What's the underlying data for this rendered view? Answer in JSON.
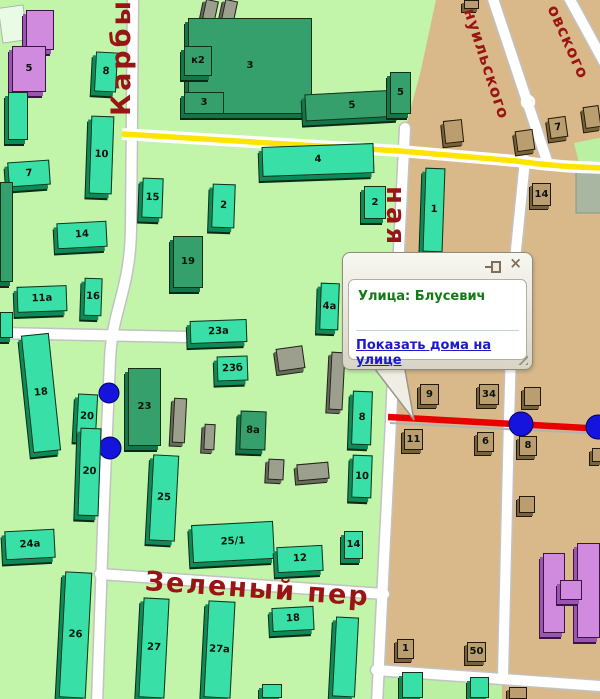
{
  "colors": {
    "map_green": "#c2f4aa",
    "map_tan": "#d9b989",
    "road_yellow": "#ffe400",
    "accent_red": "#e80000",
    "marker_blue": "#1414dd",
    "street_label": "#991414",
    "popup_title_green": "#157a15",
    "link_blue": "#1a1acc"
  },
  "popup": {
    "title": "Улица: Блусевич",
    "link_label": "Показать дома на улице",
    "close_glyph": "×",
    "tail_points": "371,364 404,364 414,420"
  },
  "map": {
    "street_labels": [
      {
        "text": "Карбыш",
        "x": 106,
        "y": 116,
        "rot": -90,
        "size": 27,
        "ls": 3
      },
      {
        "text": "ная",
        "x": 410,
        "y": 186,
        "rot": 90,
        "size": 26,
        "ls": 3
      },
      {
        "text": "Зеленый пер",
        "x": 146,
        "y": 566,
        "rot": 4,
        "size": 27,
        "ls": 2
      },
      {
        "text": "нуильского",
        "x": 478,
        "y": 6,
        "rot": 72,
        "size": 16,
        "ls": 1
      },
      {
        "text": "овского",
        "x": 561,
        "y": 2,
        "rot": 66,
        "size": 16,
        "ls": 1
      }
    ],
    "markers": [
      {
        "x": 109,
        "y": 393,
        "r": 10
      },
      {
        "x": 110,
        "y": 448,
        "r": 11
      },
      {
        "x": 521,
        "y": 424,
        "r": 12
      },
      {
        "x": 598,
        "y": 427,
        "r": 12
      }
    ],
    "buildings": [
      {
        "l": "",
        "x": 0,
        "y": 6,
        "w": 26,
        "h": 36,
        "r": -8,
        "t": "pale"
      },
      {
        "l": "",
        "x": 26,
        "y": 10,
        "w": 28,
        "h": 40,
        "r": 0,
        "t": "purple"
      },
      {
        "l": "5",
        "x": 12,
        "y": 46,
        "w": 34,
        "h": 46,
        "r": 0,
        "t": "purple"
      },
      {
        "l": "8",
        "x": 95,
        "y": 52,
        "w": 22,
        "h": 40,
        "r": 3,
        "t": "teal"
      },
      {
        "l": "",
        "x": 8,
        "y": 92,
        "w": 20,
        "h": 48,
        "r": 0,
        "t": "teal"
      },
      {
        "l": "10",
        "x": 90,
        "y": 116,
        "w": 23,
        "h": 78,
        "r": 2,
        "t": "teal"
      },
      {
        "l": "7",
        "x": 8,
        "y": 161,
        "w": 42,
        "h": 25,
        "r": -4,
        "t": "teal"
      },
      {
        "l": "",
        "x": 204,
        "y": 0,
        "w": 13,
        "h": 20,
        "r": 12,
        "t": "grey"
      },
      {
        "l": "",
        "x": 223,
        "y": 0,
        "w": 13,
        "h": 22,
        "r": 12,
        "t": "grey"
      },
      {
        "l": "3",
        "x": 188,
        "y": 18,
        "w": 124,
        "h": 96,
        "r": 0,
        "t": "dark"
      },
      {
        "l": "к2",
        "x": 184,
        "y": 46,
        "w": 28,
        "h": 30,
        "r": 0,
        "t": "dark"
      },
      {
        "l": "3",
        "x": 184,
        "y": 92,
        "w": 40,
        "h": 22,
        "r": 0,
        "t": "dark"
      },
      {
        "l": "5",
        "x": 305,
        "y": 92,
        "w": 94,
        "h": 27,
        "r": -3,
        "t": "dark"
      },
      {
        "l": "5",
        "x": 390,
        "y": 72,
        "w": 21,
        "h": 42,
        "r": 0,
        "t": "dark"
      },
      {
        "l": "4",
        "x": 262,
        "y": 145,
        "w": 112,
        "h": 30,
        "r": -2,
        "t": "teal"
      },
      {
        "l": "1",
        "x": 424,
        "y": 168,
        "w": 20,
        "h": 84,
        "r": 2,
        "t": "teal"
      },
      {
        "l": "2",
        "x": 364,
        "y": 186,
        "w": 22,
        "h": 33,
        "r": 0,
        "t": "teal"
      },
      {
        "l": "15",
        "x": 142,
        "y": 178,
        "w": 21,
        "h": 40,
        "r": 2,
        "t": "teal"
      },
      {
        "l": "2",
        "x": 212,
        "y": 184,
        "w": 23,
        "h": 44,
        "r": 2,
        "t": "teal"
      },
      {
        "l": "14",
        "x": 57,
        "y": 222,
        "w": 50,
        "h": 26,
        "r": -3,
        "t": "teal"
      },
      {
        "l": "19",
        "x": 173,
        "y": 236,
        "w": 30,
        "h": 52,
        "r": 0,
        "t": "dark"
      },
      {
        "l": "11a",
        "x": 17,
        "y": 286,
        "w": 50,
        "h": 26,
        "r": -2,
        "t": "teal"
      },
      {
        "l": "16",
        "x": 84,
        "y": 278,
        "w": 18,
        "h": 38,
        "r": 2,
        "t": "teal"
      },
      {
        "l": "",
        "x": 0,
        "y": 182,
        "w": 13,
        "h": 100,
        "r": 0,
        "t": "dark"
      },
      {
        "l": "",
        "x": 0,
        "y": 312,
        "w": 13,
        "h": 26,
        "r": 0,
        "t": "teal"
      },
      {
        "l": "4a",
        "x": 320,
        "y": 283,
        "w": 19,
        "h": 47,
        "r": 2,
        "t": "teal"
      },
      {
        "l": "23a",
        "x": 190,
        "y": 320,
        "w": 57,
        "h": 23,
        "r": -2,
        "t": "teal"
      },
      {
        "l": "23б",
        "x": 217,
        "y": 356,
        "w": 31,
        "h": 25,
        "r": -2,
        "t": "teal"
      },
      {
        "l": "8a",
        "x": 240,
        "y": 411,
        "w": 26,
        "h": 39,
        "r": 2,
        "t": "dark"
      },
      {
        "l": "8",
        "x": 352,
        "y": 391,
        "w": 20,
        "h": 54,
        "r": 2,
        "t": "teal"
      },
      {
        "l": "10",
        "x": 352,
        "y": 455,
        "w": 20,
        "h": 43,
        "r": 2,
        "t": "teal"
      },
      {
        "l": "23",
        "x": 128,
        "y": 368,
        "w": 33,
        "h": 78,
        "r": 0,
        "t": "dark"
      },
      {
        "l": "18",
        "x": 27,
        "y": 334,
        "w": 28,
        "h": 118,
        "r": -6,
        "t": "teal"
      },
      {
        "l": "20",
        "x": 77,
        "y": 394,
        "w": 20,
        "h": 45,
        "r": 3,
        "t": "teal"
      },
      {
        "l": "20",
        "x": 79,
        "y": 428,
        "w": 21,
        "h": 88,
        "r": 2,
        "t": "teal"
      },
      {
        "l": "25",
        "x": 151,
        "y": 455,
        "w": 26,
        "h": 86,
        "r": 3,
        "t": "teal"
      },
      {
        "l": "24a",
        "x": 5,
        "y": 530,
        "w": 50,
        "h": 29,
        "r": -3,
        "t": "teal"
      },
      {
        "l": "25/1",
        "x": 192,
        "y": 523,
        "w": 82,
        "h": 38,
        "r": -3,
        "t": "teal"
      },
      {
        "l": "12",
        "x": 277,
        "y": 546,
        "w": 46,
        "h": 26,
        "r": -3,
        "t": "teal"
      },
      {
        "l": "14",
        "x": 344,
        "y": 531,
        "w": 19,
        "h": 28,
        "r": 0,
        "t": "teal"
      },
      {
        "l": "18",
        "x": 272,
        "y": 607,
        "w": 42,
        "h": 24,
        "r": -3,
        "t": "teal"
      },
      {
        "l": "26",
        "x": 62,
        "y": 572,
        "w": 27,
        "h": 126,
        "r": 3,
        "t": "teal"
      },
      {
        "l": "27",
        "x": 141,
        "y": 598,
        "w": 26,
        "h": 100,
        "r": 3,
        "t": "teal"
      },
      {
        "l": "27a",
        "x": 206,
        "y": 601,
        "w": 27,
        "h": 97,
        "r": 3,
        "t": "teal"
      },
      {
        "l": "",
        "x": 334,
        "y": 617,
        "w": 23,
        "h": 80,
        "r": 3,
        "t": "teal"
      },
      {
        "l": "",
        "x": 262,
        "y": 684,
        "w": 20,
        "h": 14,
        "r": 0,
        "t": "teal"
      },
      {
        "l": "",
        "x": 402,
        "y": 672,
        "w": 21,
        "h": 26,
        "r": 0,
        "t": "teal"
      },
      {
        "l": "",
        "x": 470,
        "y": 677,
        "w": 19,
        "h": 21,
        "r": 0,
        "t": "teal"
      },
      {
        "l": "",
        "x": 277,
        "y": 347,
        "w": 27,
        "h": 23,
        "r": -8,
        "t": "grey"
      },
      {
        "l": "",
        "x": 330,
        "y": 352,
        "w": 14,
        "h": 58,
        "r": 3,
        "t": "grey"
      },
      {
        "l": "",
        "x": 173,
        "y": 398,
        "w": 13,
        "h": 45,
        "r": 3,
        "t": "grey"
      },
      {
        "l": "",
        "x": 204,
        "y": 424,
        "w": 11,
        "h": 26,
        "r": 3,
        "t": "grey"
      },
      {
        "l": "",
        "x": 268,
        "y": 459,
        "w": 16,
        "h": 21,
        "r": 3,
        "t": "grey"
      },
      {
        "l": "",
        "x": 297,
        "y": 463,
        "w": 32,
        "h": 17,
        "r": -5,
        "t": "grey"
      },
      {
        "l": "",
        "x": 464,
        "y": 0,
        "w": 15,
        "h": 9,
        "r": 0,
        "t": "brown"
      },
      {
        "l": "",
        "x": 444,
        "y": 120,
        "w": 19,
        "h": 23,
        "r": -6,
        "t": "brown"
      },
      {
        "l": "",
        "x": 516,
        "y": 130,
        "w": 18,
        "h": 21,
        "r": -8,
        "t": "brown"
      },
      {
        "l": "7",
        "x": 549,
        "y": 117,
        "w": 18,
        "h": 21,
        "r": -8,
        "t": "brown"
      },
      {
        "l": "",
        "x": 584,
        "y": 106,
        "w": 16,
        "h": 22,
        "r": -8,
        "t": "brown"
      },
      {
        "l": "14",
        "x": 532,
        "y": 183,
        "w": 19,
        "h": 23,
        "r": 0,
        "t": "brown"
      },
      {
        "l": "9",
        "x": 420,
        "y": 384,
        "w": 19,
        "h": 21,
        "r": 0,
        "t": "brown"
      },
      {
        "l": "34",
        "x": 479,
        "y": 384,
        "w": 20,
        "h": 21,
        "r": 0,
        "t": "brown"
      },
      {
        "l": "",
        "x": 524,
        "y": 387,
        "w": 17,
        "h": 19,
        "r": 0,
        "t": "brown"
      },
      {
        "l": "11",
        "x": 404,
        "y": 429,
        "w": 19,
        "h": 21,
        "r": 0,
        "t": "brown"
      },
      {
        "l": "6",
        "x": 477,
        "y": 432,
        "w": 17,
        "h": 20,
        "r": 0,
        "t": "brown"
      },
      {
        "l": "8",
        "x": 519,
        "y": 436,
        "w": 18,
        "h": 20,
        "r": 0,
        "t": "brown"
      },
      {
        "l": "",
        "x": 519,
        "y": 496,
        "w": 16,
        "h": 17,
        "r": 0,
        "t": "brown"
      },
      {
        "l": "",
        "x": 592,
        "y": 448,
        "w": 10,
        "h": 14,
        "r": 0,
        "t": "brown"
      },
      {
        "l": "1",
        "x": 397,
        "y": 639,
        "w": 17,
        "h": 20,
        "r": 0,
        "t": "brown"
      },
      {
        "l": "50",
        "x": 467,
        "y": 642,
        "w": 19,
        "h": 20,
        "r": 0,
        "t": "brown"
      },
      {
        "l": "",
        "x": 509,
        "y": 687,
        "w": 18,
        "h": 12,
        "r": 0,
        "t": "brown"
      },
      {
        "l": "",
        "x": 543,
        "y": 553,
        "w": 22,
        "h": 80,
        "r": 0,
        "t": "purple"
      },
      {
        "l": "",
        "x": 577,
        "y": 543,
        "w": 23,
        "h": 95,
        "r": 0,
        "t": "purple"
      },
      {
        "l": "",
        "x": 560,
        "y": 580,
        "w": 22,
        "h": 20,
        "r": 0,
        "t": "purple"
      }
    ],
    "geometry": {
      "tan_area": "M437,-5 L604,-5 L604,704 L377,704 L384,560 L391,420 L397,290 L405,130 L421,70 Z",
      "green_patch_br": "M376,669 L502,675 L502,704 L376,704 Z",
      "green_wedge_r": "M574,143 L604,137 L604,170 L581,171 Z",
      "zone_grey": "M576,166 L604,165 L604,213 L576,213 Z",
      "streets": "M133,-5 L131,230 C130,290 112,310 110,360 L104,500 L97,704 M-3,333 L188,337 M100,574 L384,594 M405,128 L397,290 L391,420 L384,560 L377,704 M525,160 L513,280 L509,420 L503,676 M376,670 L600,686 M492,-4 L548,164 M568,-4 L604,62",
      "yellow_road": "M122,134 L400,151 L516,161 C550,166 575,167 604,168",
      "red_under": "M390,423 L604,434",
      "red_road": "M388,417 L604,429"
    }
  }
}
